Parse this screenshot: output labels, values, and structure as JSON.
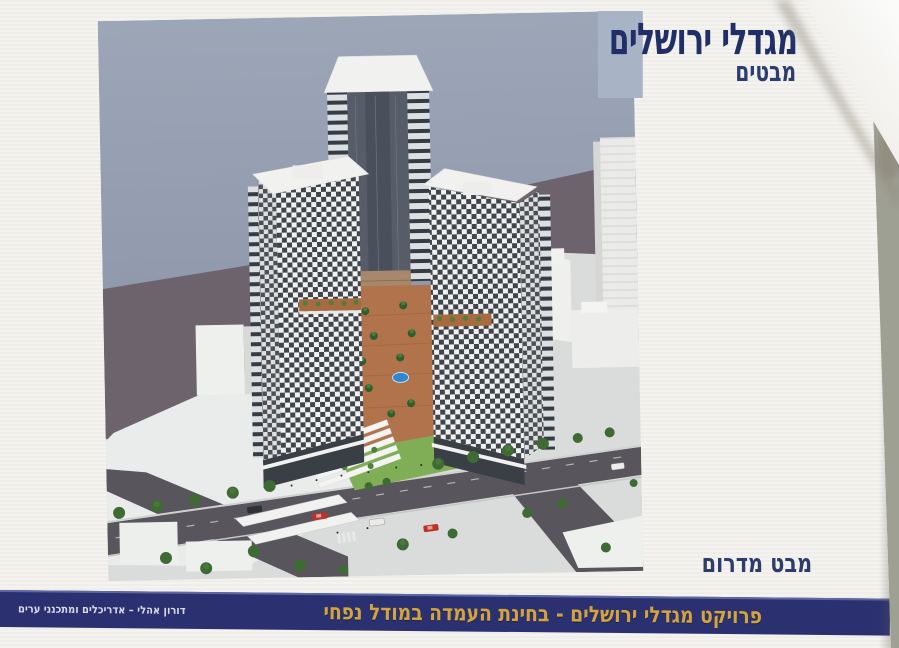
{
  "page": {
    "title": "מגדלי ירושלים",
    "subtitle": "מבטים",
    "view_label": "מבט מדרום",
    "banner_text": "פרויקט מגדלי ירושלים  -  בחינת העמדה במודל נפחי",
    "credit": "דורון אהלי – אדריכלים ומתכנני ערים"
  },
  "rendering": {
    "alt": "Aerial 3D massing render viewed from the south: two checkerboard-facade residential towers and a taller central slab tower around a palm-lined terracotta courtyard with a round blue pool, lawns and a white pergola, surrounded by streets with trees, cars and white low-rise buildings"
  },
  "colors": {
    "banner_navy": "#2b3170",
    "banner_gold": "#d4a43c",
    "title_navy": "#203067",
    "title_square": "#a8b3c6",
    "sky": "#98a2b4",
    "page": "#f3f2ef",
    "desk": "#a9ab9d"
  }
}
